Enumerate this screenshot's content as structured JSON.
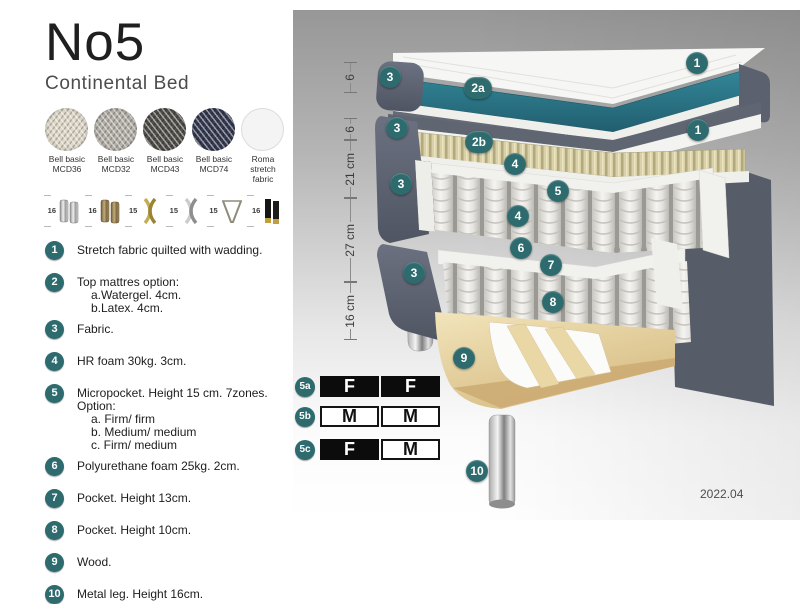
{
  "header": {
    "title": "No5",
    "subtitle": "Continental Bed"
  },
  "fabrics": [
    {
      "name_line1": "Bell basic",
      "name_line2": "MCD36"
    },
    {
      "name_line1": "Bell basic",
      "name_line2": "MCD32"
    },
    {
      "name_line1": "Bell basic",
      "name_line2": "MCD43"
    },
    {
      "name_line1": "Bell basic",
      "name_line2": "MCD74"
    },
    {
      "name_line1": "Roma",
      "name_line2": "stretch fabric"
    }
  ],
  "legs": [
    {
      "height": "16",
      "style": "cylinder-silver"
    },
    {
      "height": "16",
      "style": "cylinder-bronze"
    },
    {
      "height": "15",
      "style": "cross-gold"
    },
    {
      "height": "15",
      "style": "cross-silver"
    },
    {
      "height": "15",
      "style": "hairpin-metal"
    },
    {
      "height": "16",
      "style": "block-black-gold"
    }
  ],
  "features": [
    {
      "num": "1",
      "text": "Stretch fabric quilted with wadding."
    },
    {
      "num": "2",
      "text": "Top mattres option:",
      "subs": [
        "a.Watergel. 4cm.",
        "b.Latex. 4cm."
      ]
    },
    {
      "num": "3",
      "text": "Fabric."
    },
    {
      "num": "4",
      "text": "HR foam 30kg. 3cm."
    },
    {
      "num": "5",
      "text": "Micropocket. Height 15 cm. 7zones. Option:",
      "subs": [
        "a. Firm/ firm",
        "b. Medium/ medium",
        "c. Firm/ medium"
      ]
    },
    {
      "num": "6",
      "text": "Polyurethane foam 25kg. 2cm."
    },
    {
      "num": "7",
      "text": "Pocket. Height 13cm."
    },
    {
      "num": "8",
      "text": "Pocket. Height 10cm."
    },
    {
      "num": "9",
      "text": "Wood."
    },
    {
      "num": "10",
      "text": "Metal leg. Height 16cm."
    }
  ],
  "diagram": {
    "dimensions": [
      "6",
      "6",
      "21 cm",
      "27 cm",
      "16 cm"
    ],
    "badges": [
      {
        "label": "3"
      },
      {
        "label": "2a"
      },
      {
        "label": "1"
      },
      {
        "label": "3"
      },
      {
        "label": "2b"
      },
      {
        "label": "1"
      },
      {
        "label": "4"
      },
      {
        "label": "5"
      },
      {
        "label": "4"
      },
      {
        "label": "3"
      },
      {
        "label": "6"
      },
      {
        "label": "7"
      },
      {
        "label": "3"
      },
      {
        "label": "8"
      },
      {
        "label": "9"
      },
      {
        "label": "10"
      }
    ],
    "firmness_table": [
      {
        "badge": "5a",
        "cells": [
          {
            "text": "F",
            "variant": "dark"
          },
          {
            "text": "F",
            "variant": "dark"
          }
        ]
      },
      {
        "badge": "5b",
        "cells": [
          {
            "text": "M",
            "variant": "light"
          },
          {
            "text": "M",
            "variant": "light"
          }
        ]
      },
      {
        "badge": "5c",
        "cells": [
          {
            "text": "F",
            "variant": "dark"
          },
          {
            "text": "M",
            "variant": "light"
          }
        ]
      }
    ],
    "date": "2022.04"
  },
  "colors": {
    "badge_teal": "#2d6b6e",
    "mattress_teal": "#2e7d8e",
    "fabric_dark": "#5a606d"
  }
}
